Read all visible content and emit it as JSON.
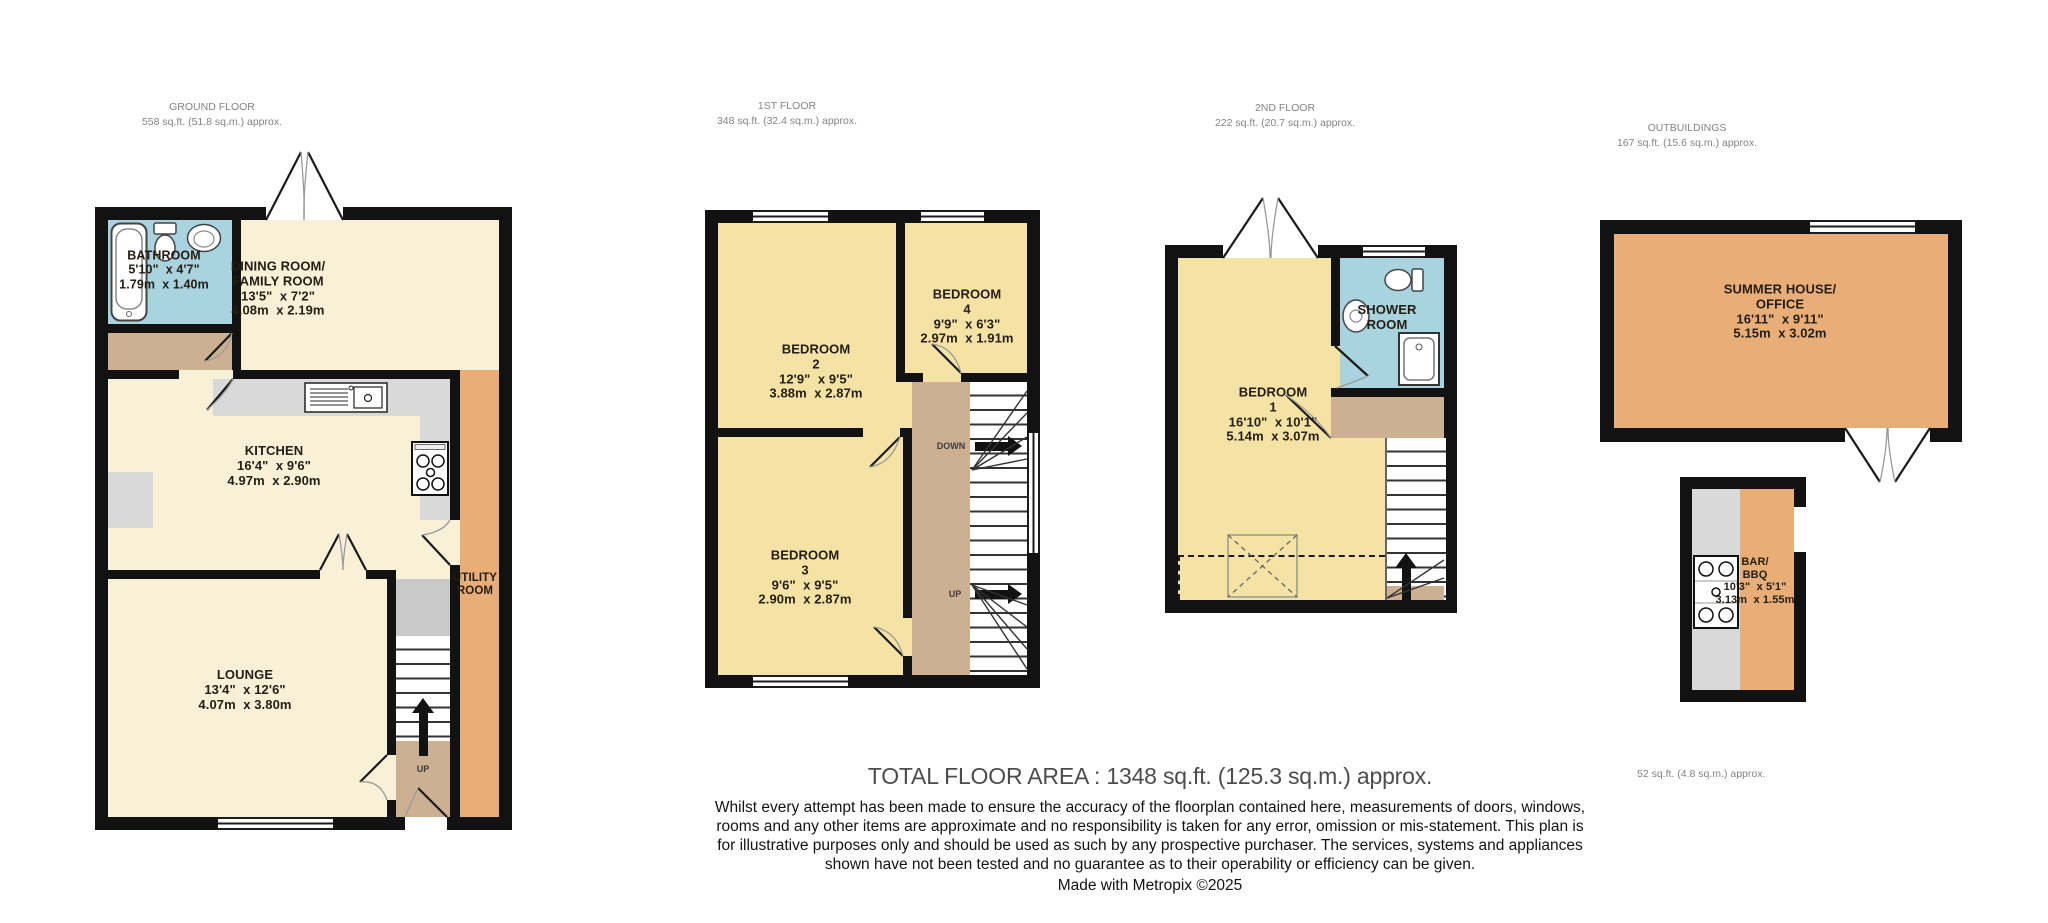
{
  "headers": [
    {
      "title": "GROUND FLOOR",
      "area": "558 sq.ft. (51.8 sq.m.) approx."
    },
    {
      "title": "1ST FLOOR",
      "area": "348 sq.ft. (32.4 sq.m.) approx."
    },
    {
      "title": "2ND FLOOR",
      "area": "222 sq.ft. (20.7 sq.m.) approx."
    },
    {
      "title": "OUTBUILDINGS",
      "area": "167 sq.ft. (15.6 sq.m.) approx."
    }
  ],
  "rooms": {
    "bathroom": {
      "label": "BATHROOM\n5'10\"  x 4'7\"\n1.79m  x 1.40m"
    },
    "dining": {
      "label": "DINING ROOM/\nFAMILY ROOM\n13'5\"  x 7'2\"\n4.08m  x 2.19m"
    },
    "kitchen": {
      "label": "KITCHEN\n16'4\"  x 9'6\"\n4.97m  x 2.90m"
    },
    "utility": {
      "label": "UTILITY\nROOM"
    },
    "lounge": {
      "label": "LOUNGE\n13'4\"  x 12'6\"\n4.07m  x 3.80m"
    },
    "bedroom2": {
      "label": "BEDROOM\n2\n12'9\"  x 9'5\"\n3.88m  x 2.87m"
    },
    "bedroom4": {
      "label": "BEDROOM\n4\n9'9\"  x 6'3\"\n2.97m  x 1.91m"
    },
    "bedroom3": {
      "label": "BEDROOM\n3\n9'6\"  x 9'5\"\n2.90m  x 2.87m"
    },
    "bedroom1": {
      "label": "BEDROOM\n1\n16'10\"  x 10'1\"\n5.14m  x 3.07m"
    },
    "shower": {
      "label": "SHOWER\nROOM"
    },
    "summer": {
      "label": "SUMMER HOUSE/\nOFFICE\n16'11\"  x 9'11\"\n5.15m  x 3.02m"
    },
    "bar": {
      "label": "BAR/\nBBQ\n10'3\"  x 5'1\"\n3.13m  x 1.55m"
    }
  },
  "stairs": {
    "up": "UP",
    "down": "DOWN"
  },
  "bar_area_note": "52 sq.ft. (4.8 sq.m.) approx.",
  "footer": {
    "total": "TOTAL FLOOR AREA : 1348 sq.ft. (125.3 sq.m.) approx.",
    "disclaimer": "Whilst every attempt has been made to ensure the accuracy of the floorplan contained here, measurements of doors, windows, rooms and any other items are approximate and no responsibility is taken for any error, omission or mis-statement. This plan is for illustrative purposes only and should be used as such by any prospective purchaser. The services, systems and appliances shown have not been tested and no guarantee as to their operability or efficiency can be given.",
    "credit": "Made with Metropix ©2025"
  },
  "colors": {
    "cream": "#f8f1d8",
    "bedroom_yellow": "#f5e3a6",
    "bathroom_blue": "#a9d3de",
    "hall_tan": "#cdb091",
    "outbuilding_orange": "#e9ae77",
    "counter_grey": "#d9d9d9",
    "wall": "#121212"
  }
}
